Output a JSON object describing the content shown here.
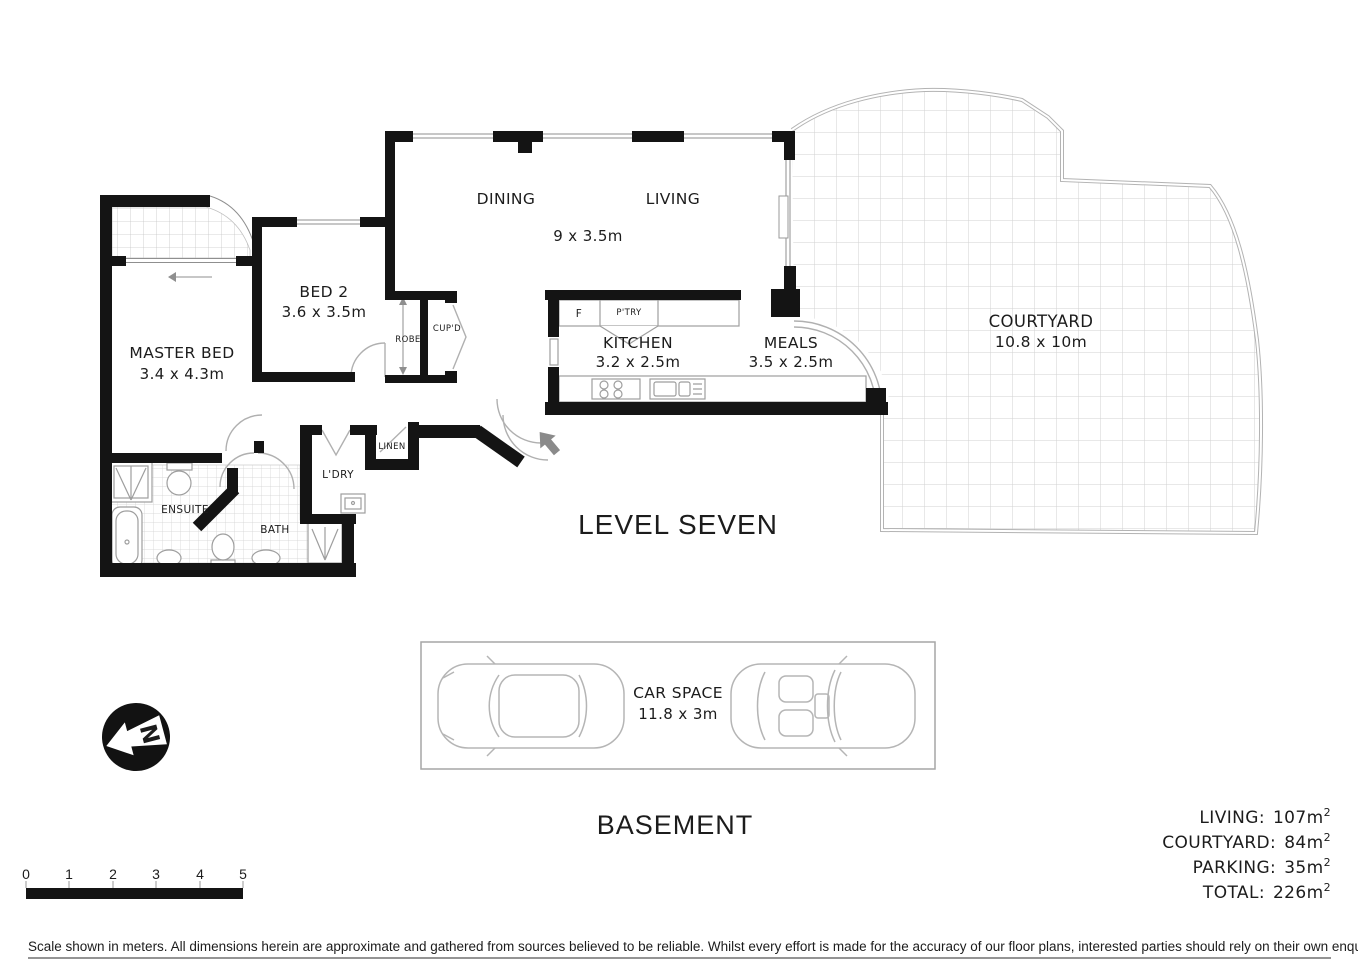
{
  "plan": {
    "level_label": "LEVEL SEVEN",
    "basement_label": "BASEMENT",
    "rooms": {
      "dining": "DINING",
      "living": "LIVING",
      "living_dining_dims": "9 x 3.5m",
      "bed2": "BED 2",
      "bed2_dims": "3.6 x 3.5m",
      "master": "MASTER BED",
      "master_dims": "3.4 x 4.3m",
      "kitchen": "KITCHEN",
      "kitchen_dims": "3.2 x 2.5m",
      "meals": "MEALS",
      "meals_dims": "3.5 x 2.5m",
      "courtyard": "COURTYARD",
      "courtyard_dims": "10.8 x 10m",
      "ensuite": "ENSUITE",
      "bath": "BATH",
      "laundry": "L'DRY",
      "linen": "LINEN",
      "robe": "ROBE",
      "cupboard": "CUP'D",
      "fridge": "F",
      "pantry": "P'TRY"
    },
    "car_space": {
      "label": "CAR SPACE",
      "dims": "11.8 x 3m"
    },
    "compass_letter": "N"
  },
  "areas": {
    "unit": "m",
    "sup": "2",
    "items": [
      {
        "label": "LIVING:",
        "value": "107"
      },
      {
        "label": "COURTYARD:",
        "value": "84"
      },
      {
        "label": "PARKING:",
        "value": "35"
      },
      {
        "label": "TOTAL:",
        "value": "226"
      }
    ]
  },
  "scale_bar": {
    "ticks": [
      "0",
      "1",
      "2",
      "3",
      "4",
      "5"
    ]
  },
  "disclaimer": "Scale shown in meters. All dimensions herein are approximate and gathered from sources believed to be  reliable. Whilst every effort is made for the accuracy of our floor plans, interested parties should rely on their own enquiries.",
  "colors": {
    "wall": "#141414",
    "text": "#1c1c1c",
    "lightline": "#b0b0b0"
  }
}
